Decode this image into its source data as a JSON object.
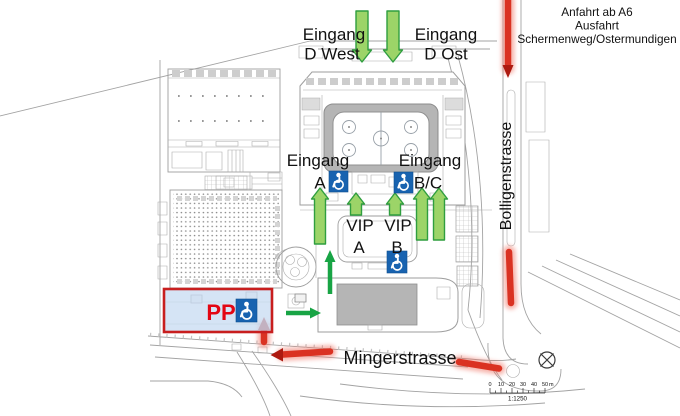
{
  "note": {
    "lines": [
      "Anfahrt ab A6",
      "Ausfahrt",
      "Schermenweg/Ostermundigen"
    ]
  },
  "entrances": {
    "d_west": {
      "line1": "Eingang",
      "line2": "D West"
    },
    "d_ost": {
      "line1": "Eingang",
      "line2": "D Ost"
    },
    "a": {
      "line1": "Eingang",
      "line2": "A"
    },
    "bc": {
      "line1": "Eingang",
      "line2": "B/C"
    }
  },
  "vip": {
    "a": {
      "line1": "VIP",
      "line2": "A"
    },
    "b": {
      "line1": "VIP",
      "line2": "B"
    }
  },
  "parking": {
    "label": "PP"
  },
  "streets": {
    "minger": "Mingerstrasse",
    "bolligen": "Bolligenstrasse"
  },
  "scale": {
    "ticks": [
      "0",
      "10",
      "20",
      "30",
      "40",
      "50"
    ],
    "unit": "m",
    "ratio": "1:1250"
  },
  "icons": {
    "wheelchair": "♿"
  },
  "colors": {
    "arrow_green": "#9CD468",
    "arrow_green_outline": "#2F9E3F",
    "route_green": "#18A445",
    "highlight_red": "#DA3222",
    "arrow_dark_red": "#AD1A10",
    "accessible_blue": "#1863B0",
    "pp_text_red": "#E30613",
    "pp_zone_fill": "#C9DDF2",
    "pp_zone_border": "#C81E1E",
    "plan_line_gray": "#9E9E9E",
    "stands_gray": "#B5B5B5"
  }
}
